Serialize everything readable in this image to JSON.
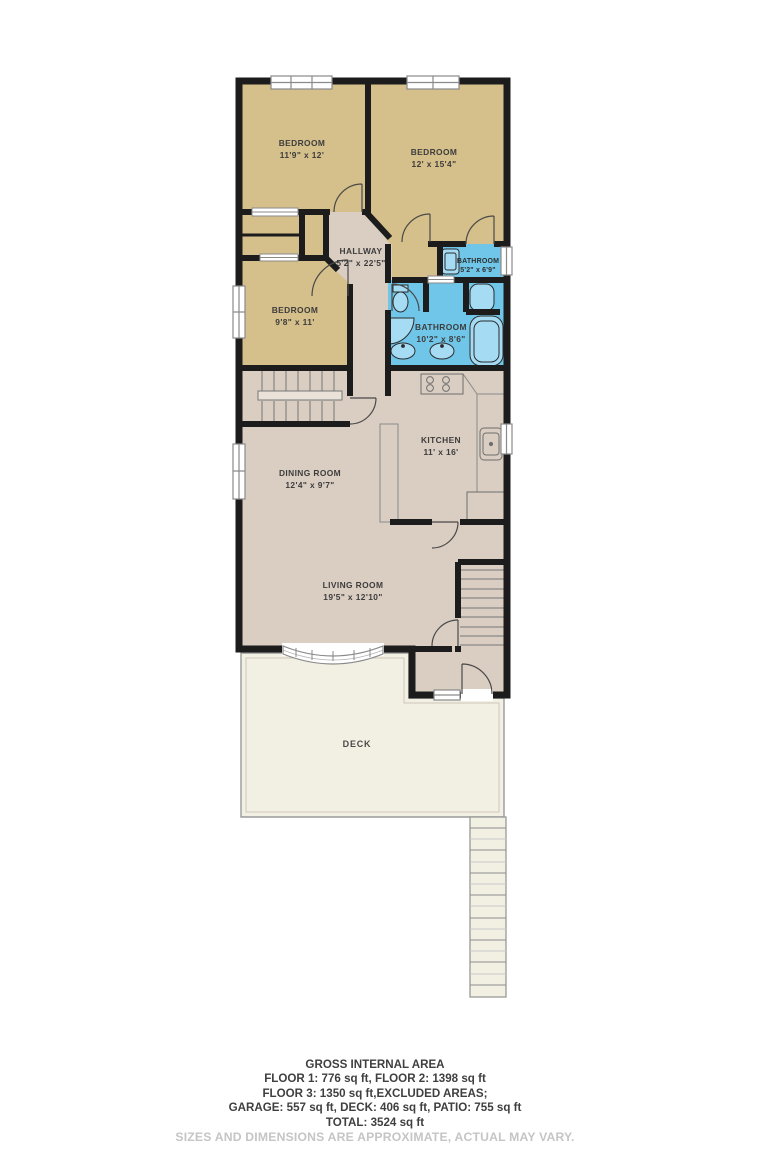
{
  "rooms": {
    "bedroom1": {
      "name": "BEDROOM",
      "dims": "11'9\" x 12'"
    },
    "bedroom2": {
      "name": "BEDROOM",
      "dims": "12' x 15'4\""
    },
    "bedroom3": {
      "name": "BEDROOM",
      "dims": "9'8\" x 11'"
    },
    "hallway": {
      "name": "HALLWAY",
      "dims": "5'2\" x 22'5\""
    },
    "bathroom_small": {
      "name": "BATHROOM",
      "dims": "5'2\" x 6'9\""
    },
    "bathroom_main": {
      "name": "BATHROOM",
      "dims": "10'2\" x 8'6\""
    },
    "kitchen": {
      "name": "KITCHEN",
      "dims": "11' x 16'"
    },
    "dining_room": {
      "name": "DINING ROOM",
      "dims": "12'4\" x 9'7\""
    },
    "living_room": {
      "name": "LIVING ROOM",
      "dims": "19'5\" x 12'10\""
    },
    "deck": {
      "name": "DECK"
    }
  },
  "summary": {
    "title": "GROSS INTERNAL AREA",
    "line1": "FLOOR 1: 776 sq ft, FLOOR 2: 1398 sq ft",
    "line2": "FLOOR 3: 1350 sq ft,EXCLUDED AREAS;",
    "line3": "GARAGE: 557 sq ft, DECK: 406 sq ft, PATIO: 755 sq ft",
    "line4": "TOTAL: 3524 sq ft",
    "disclaimer": "SIZES AND DIMENSIONS ARE APPROXIMATE, ACTUAL MAY VARY."
  },
  "colors": {
    "wall": "#1c1c1c",
    "bedroom_fill": "#d5bf8a",
    "hall_fill": "#dacdc2",
    "bathroom_fill": "#6fc6e8",
    "deck_fill": "#f2efe3",
    "label_text": "#3d3d3d",
    "disclaimer_text": "#c5c5c5"
  }
}
